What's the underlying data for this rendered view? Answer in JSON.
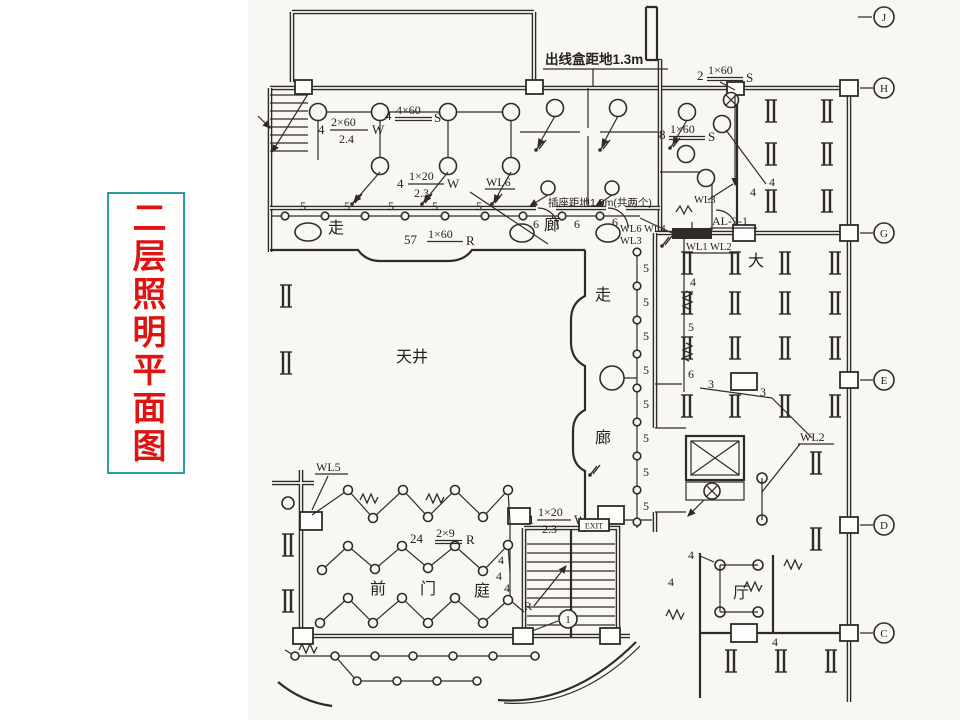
{
  "title": {
    "text": "二层照明平面图"
  },
  "notes": {
    "outlet_box": "出线盒距地1.3m",
    "socket": "插座距地1.9m(共两个)"
  },
  "rooms": {
    "zou": "走",
    "lang": "廊",
    "tianjing": "天井",
    "da": "大",
    "qian": "前",
    "men": "门",
    "tingyuan": "庭",
    "ting": "厅"
  },
  "circuits": {
    "wl6": "WL6",
    "wl5": "WL5",
    "wl2": "WL2",
    "wl3": "WL3",
    "wl6wl4": "WL6 WL4",
    "wl1wl2": "WL1 WL2",
    "al": "AL-2-1",
    "r": "R",
    "exit": "EXIT"
  },
  "fixture_labels": {
    "l1": {
      "qty": "4",
      "num": "2×60",
      "den": "2.4",
      "suffix": "W"
    },
    "l2": {
      "qty": "4",
      "num": "4×60",
      "den": "",
      "suffix": "S"
    },
    "l3": {
      "qty": "4",
      "num": "1×20",
      "den": "2.3",
      "suffix": "W"
    },
    "l4": {
      "qty": "2",
      "num": "1×60",
      "den": "",
      "suffix": "S"
    },
    "l5": {
      "qty": "8",
      "num": "1×60",
      "den": "",
      "suffix": "S"
    },
    "l6": {
      "qty": "57",
      "num": "1×60",
      "den": "",
      "suffix": "R"
    },
    "l7": {
      "qty": "24",
      "num": "2×9",
      "den": "",
      "suffix": "R"
    },
    "l8": {
      "qty": "1",
      "num": "1×20",
      "den": "2.3",
      "suffix": "W"
    }
  },
  "counts": {
    "three": "3",
    "four": "4",
    "five": "5",
    "six": "6"
  },
  "grid": {
    "J": "J",
    "H": "H",
    "G": "G",
    "E": "E",
    "D": "D",
    "C": "C",
    "one": "1"
  }
}
